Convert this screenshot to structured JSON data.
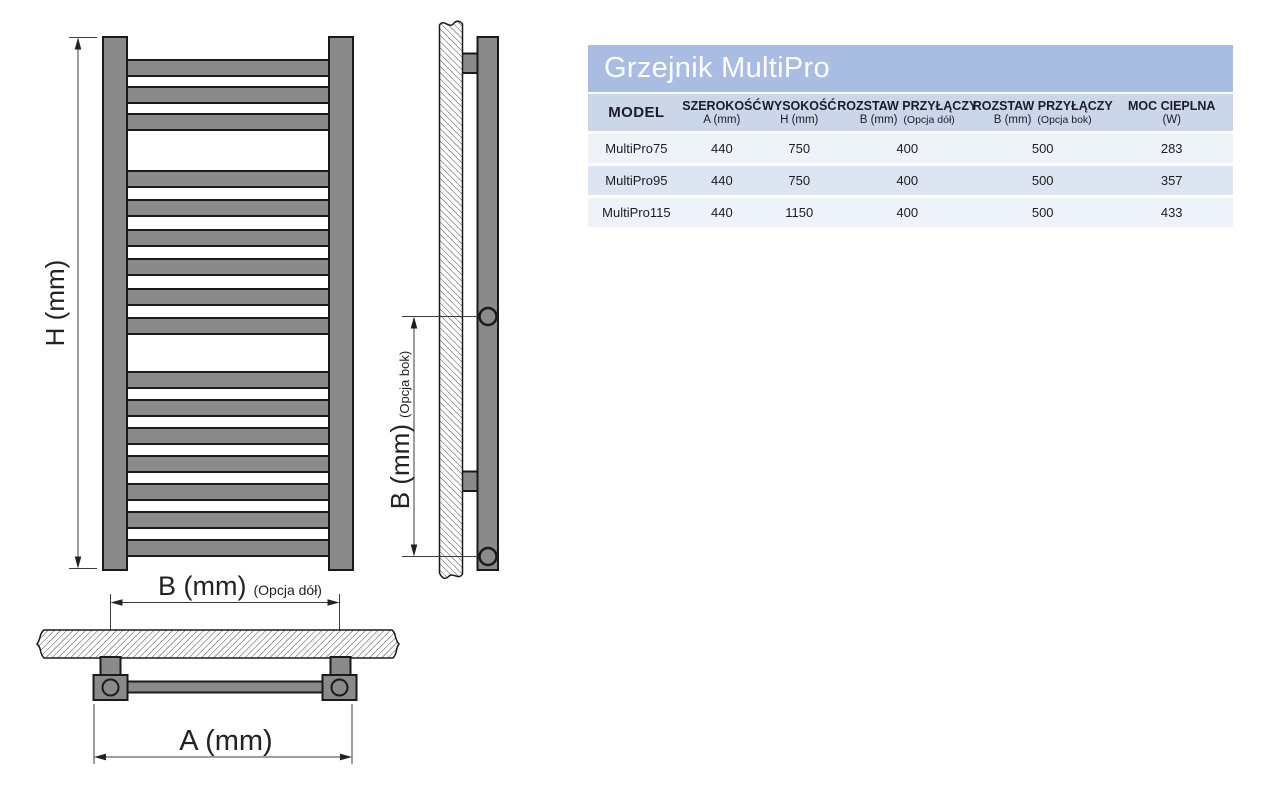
{
  "diagram": {
    "front_view": {
      "height_label": "H (mm)",
      "bottom_spacing_label": "B (mm)",
      "bottom_spacing_option": "(Opcja dół)",
      "width_label": "A (mm)"
    },
    "side_view": {
      "side_spacing_label": "B (mm)",
      "side_spacing_option": "(Opcja bok)"
    }
  },
  "table": {
    "title": "Grzejnik MultiPro",
    "columns": [
      {
        "line1": "MODEL"
      },
      {
        "line1": "SZEROKOŚĆ",
        "line2": "A (mm)"
      },
      {
        "line1": "WYSOKOŚĆ",
        "line2": "H (mm)"
      },
      {
        "line1": "ROZSTAW PRZYŁĄCZY",
        "line2": "B (mm)",
        "line2b": "(Opcja dół)"
      },
      {
        "line1": "ROZSTAW PRZYŁĄCZY",
        "line2": "B (mm)",
        "line2b": "(Opcja bok)"
      },
      {
        "line1": "MOC CIEPLNA",
        "line2": "(W)"
      }
    ],
    "rows": [
      [
        "MultiPro75",
        "440",
        "750",
        "400",
        "500",
        "283"
      ],
      [
        "MultiPro95",
        "440",
        "750",
        "400",
        "500",
        "357"
      ],
      [
        "MultiPro115",
        "440",
        "1150",
        "400",
        "500",
        "433"
      ]
    ]
  },
  "colors": {
    "radiator_gray": "#8a8a8a",
    "outline_black": "#1a1a1a",
    "dimension_line": "#3c3c3c",
    "table_title_bg": "#a9bce2",
    "table_header_bg": "#ccd6e9",
    "row_light": "#eef2f9",
    "row_mid": "#dde4f2",
    "title_text": "#ffffff"
  }
}
